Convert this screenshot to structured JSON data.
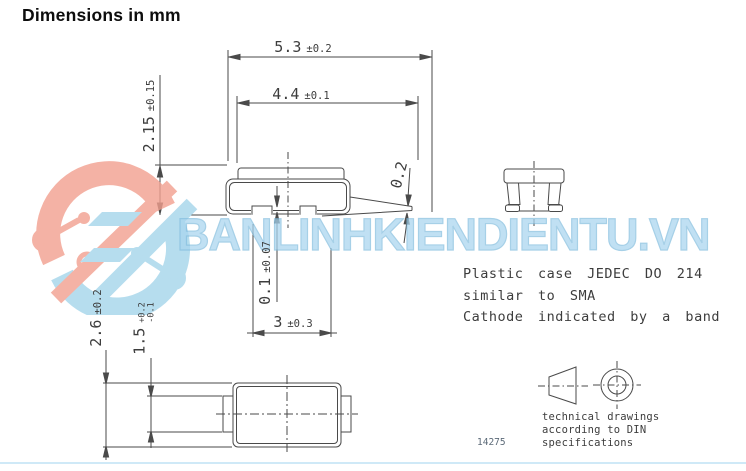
{
  "header": {
    "title": "Dimensions in mm"
  },
  "drawing": {
    "dims": {
      "overall_width": {
        "value": "5.3",
        "tol": "±0.2"
      },
      "body_width": {
        "value": "4.4",
        "tol": "±0.1"
      },
      "height": {
        "value": "2.15",
        "tol": "±0.15"
      },
      "lead_thickness": {
        "value": "0.2"
      },
      "standoff": {
        "value": "0.1",
        "tol": "±0.07"
      },
      "foot_length": {
        "value": "3",
        "tol": "±0.3"
      },
      "body_depth": {
        "value": "2.6",
        "tol": "±0.2"
      },
      "lead_width": {
        "value": "1.5",
        "tol_plus": "+0.2",
        "tol_minus": "-0.1"
      }
    },
    "notes": {
      "line1": "Plastic case JEDEC DO 214",
      "line2": "similar to SMA",
      "line3": "Cathode indicated by a band"
    },
    "projection_note": {
      "line1": "technical drawings",
      "line2": "according to DIN",
      "line3": "specifications"
    },
    "doc_number": "14275"
  },
  "watermark": {
    "text": "BANLINHKIENDIENTU.VN"
  },
  "colors": {
    "line": "#4a4a4a",
    "text": "#3d3d3d",
    "watermark_blue": "#a9d5ef",
    "logo_pink": "#f2a08f",
    "logo_blue": "#a5d5ea"
  }
}
